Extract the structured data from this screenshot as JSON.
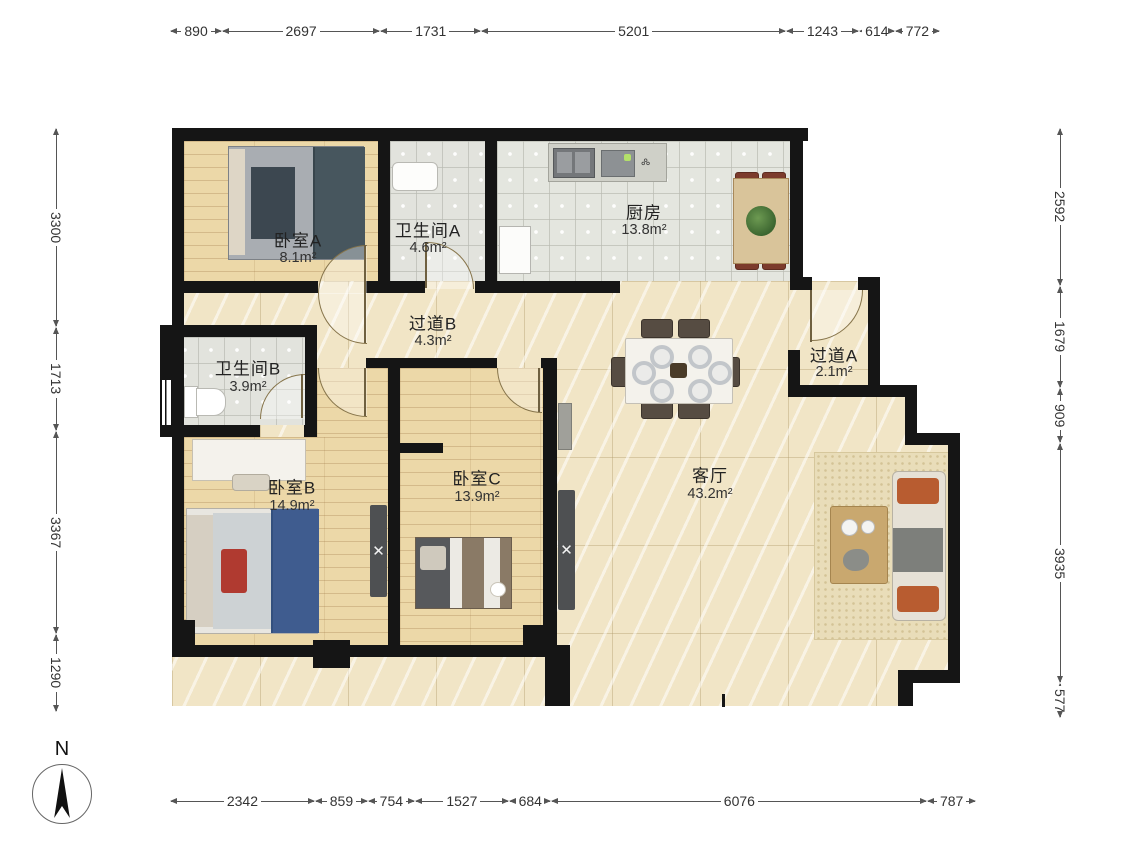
{
  "compass": {
    "label": "N"
  },
  "rooms": {
    "bedroomA": {
      "name": "卧室A",
      "area": "8.1m²"
    },
    "bathroomA": {
      "name": "卫生间A",
      "area": "4.6m²"
    },
    "kitchen": {
      "name": "厨房",
      "area": "13.8m²"
    },
    "hallwayB": {
      "name": "过道B",
      "area": "4.3m²"
    },
    "hallwayA": {
      "name": "过道A",
      "area": "2.1m²"
    },
    "bathroomB": {
      "name": "卫生间B",
      "area": "3.9m²"
    },
    "bedroomB": {
      "name": "卧室B",
      "area": "14.9m²"
    },
    "bedroomC": {
      "name": "卧室C",
      "area": "13.9m²"
    },
    "livingRoom": {
      "name": "客厅",
      "area": "43.2m²"
    }
  },
  "dimensions_mm": {
    "top": [
      "890",
      "2697",
      "1731",
      "5201",
      "1243",
      "614",
      "772"
    ],
    "bottom": [
      "2342",
      "859",
      "754",
      "1527",
      "684",
      "6076",
      "787"
    ],
    "left": [
      "3300",
      "1713",
      "3367",
      "1290"
    ],
    "right": [
      "2592",
      "1679",
      "909",
      "3935",
      "577"
    ]
  }
}
